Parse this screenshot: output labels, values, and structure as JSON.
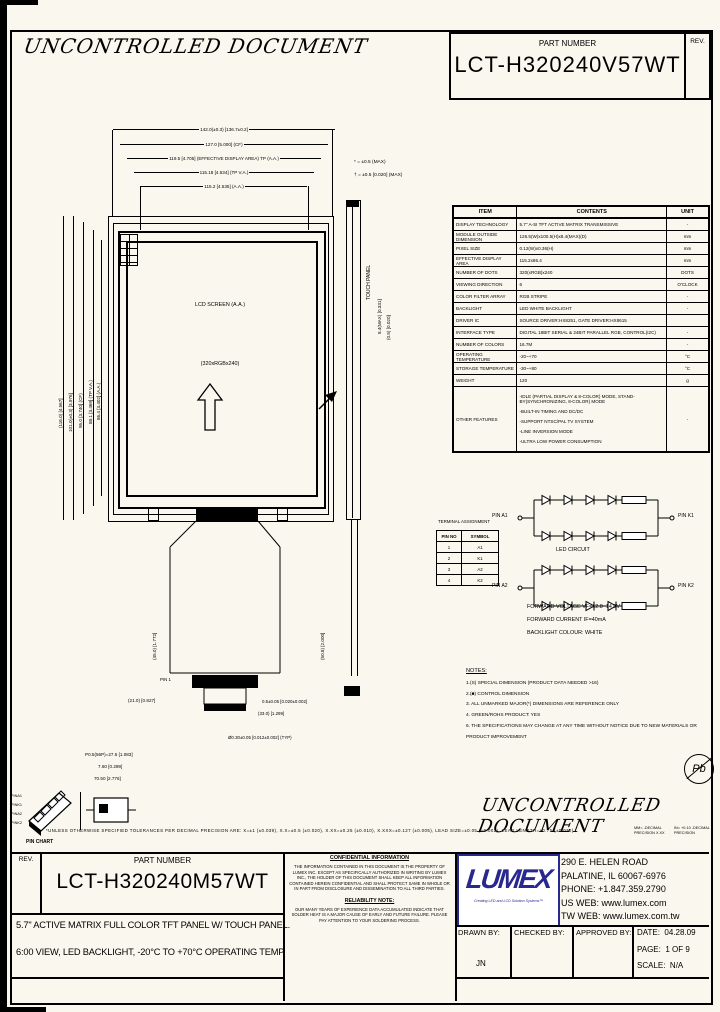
{
  "page": {
    "watermark_top": "UNCONTROLLED DOCUMENT",
    "watermark_bottom": "UNCONTROLLED DOCUMENT"
  },
  "header": {
    "part_number_label": "PART NUMBER",
    "part_number": "LCT-H320240V57WT",
    "rev_label": "REV."
  },
  "spec_table": {
    "headers": [
      "ITEM",
      "CONTENTS",
      "UNIT"
    ],
    "rows": [
      {
        "item": "DISPLAY TECHNOLOGY",
        "contents": "5.7\" A-SI TFT ACTIVE MATRIX TRANSMISSIVE",
        "unit": "-"
      },
      {
        "item": "MODULE OUTSIDE DIMENSION",
        "contents": "126.5(W)x100.5(H)x8.4(MAX)(D)",
        "unit": "mm"
      },
      {
        "item": "PIXEL SIZE",
        "contents": "0.12(W)x0.36(H)",
        "unit": "mm"
      },
      {
        "item": "EFFECTIVE DISPLAY AREA",
        "contents": "115.2x86.4",
        "unit": "mm"
      },
      {
        "item": "NUMBER OF DOTS",
        "contents": "320(xRGB)x240",
        "unit": "DOTS"
      },
      {
        "item": "VIEWING DIRECTION",
        "contents": "6",
        "unit": "O'CLOCK"
      },
      {
        "item": "COLOR FILTER ARRAY",
        "contents": "RGB STRIPE",
        "unit": "-"
      },
      {
        "item": "BACKLIGHT",
        "contents": "LED WHITE BACKLIGHT",
        "unit": "-"
      },
      {
        "item": "DRIVER IC",
        "contents": "SOURCE DRIVER:HX8251, GATE DRIVER:HX8615",
        "unit": ""
      },
      {
        "item": "INTERFACE TYPE",
        "contents": "DIGITAL 18BIT SERIAL & 24BIT PARALLEL RGB, CONTROL(I2C)",
        "unit": "-"
      },
      {
        "item": "NUMBER OF COLORS",
        "contents": "16.7M",
        "unit": "-"
      },
      {
        "item": "OPERATING TEMPERATURE",
        "contents": "-20~+70",
        "unit": "°C"
      },
      {
        "item": "STORAGE TEMPERATURE",
        "contents": "-30~+80",
        "unit": "°C"
      },
      {
        "item": "WEIGHT",
        "contents": "120",
        "unit": "g"
      }
    ],
    "other_features": {
      "item": "OTHER FEATURES",
      "lines": [
        "-IDLE (PARTIAL DISPLAY & 8-COLOR) MODE, STAND-BY(SYNCHRONIZING, 8-COLOR) MODE",
        "-BUILT-IN TIMING AND DC/DC",
        "-SUPPORT NTSC/PAL TV SYSTEM",
        "-LINE INVERSION MODE",
        "-ULTRA LOW POWER CONSUMPTION"
      ],
      "unit": "-"
    }
  },
  "drawing": {
    "top_dims": [
      "142.0(±0.3) [136.7±0.2]",
      "127.0 [5.000] (CF)",
      "119.5 [4.705] (EFFECTIVE DISPLAY AREA) TP (A.A.)",
      "115.18 [4.534] (TP V.A.)",
      "115.2 [4.535] (A.A.)"
    ],
    "left_dims": [
      "(116.0) [4.567]",
      "101.0(±0.3) [3.976]",
      "95.0 [3.740] (CF)",
      "88.1 [3.469] (TP V.A.)",
      "86.4 [3.402] (A.A.)"
    ],
    "legend": [
      "* = ±0.5 (MAX)",
      "† = ±0.5 [0.020] (MAX)"
    ],
    "screen_label": "LCD SCREEN (A.A.)",
    "dots_label": "(320xRGBx240)",
    "touch_panel_label": "TOUCH PANEL",
    "side_dims": [
      "8.4(MAX) [0.331]",
      "(0.5) [0.020]"
    ],
    "fpc_side_dim": "(50.8) [2.000]",
    "fpc_left_dim": "(45.0) [1.772]",
    "pin1_label": "PIN 1",
    "bottom_dims": [
      "(21.0) [0.827]",
      "0.5±0.05 [0.020±0.002]",
      "(33.0) [1.299]",
      "Ø0.30±0.05 [0.012±0.002] (TYP)",
      "P0.5(56P)=27.5 [1.083]",
      "7.60 [0.299]",
      "70.50 [2.776]"
    ]
  },
  "terminal_table": {
    "caption": "TERMINAL ASSIGNMENT",
    "headers": [
      "PIN NO",
      "SYMBOL"
    ],
    "rows": [
      [
        "1",
        "A1"
      ],
      [
        "2",
        "K1"
      ],
      [
        "3",
        "A2"
      ],
      [
        "4",
        "K2"
      ]
    ]
  },
  "led_circuit": {
    "caption": "LED CIRCUIT",
    "pin_a1": "PIN A1",
    "pin_k1": "PIN K1",
    "pin_a2": "PIN A2",
    "pin_k2": "PIN K2",
    "notes": [
      "FORWARD VOLTAGE VF=12.8~14.0V",
      "FORWARD CURRENT IF=40mA",
      "BACKLIGHT COLOUR: WHITE"
    ]
  },
  "notes": {
    "title": "NOTES:",
    "items": [
      "1.(S) SPECIAL DIMENSION (PRODUCT DATA NEEDED >16)",
      "2.(■) CONTROL DIMENSION",
      "3. ALL UNMARKED MAJOR(*) DIMENSIONS ARE REFERENCE ONLY",
      "4. GREEN/ROHS PRODUCT: YES",
      "6. THE SPECIFICATIONS MAY CHANGE AT ANY TIME WITHOUT NOTICE DUE TO NEW MATERIALS OR PRODUCT IMPROVEMENT"
    ]
  },
  "pin_chart": {
    "caption": "PIN CHART",
    "pins": [
      "PINA1",
      "PINK1",
      "PINA2",
      "PINK2"
    ]
  },
  "tolerance": {
    "main": "*UNLESS OTHERWISE SPECIFIED TOLERANCES PER DECIMAL PRECISION ARE: X=±1 (±0.039), X.X=±0.5 (±0.020), X.XX=±0.25 (±0.010), X.XXX=±0.127 (±0.005), LEAD SIZE=±0.05 (±0.002), LEAD LENGTH=±0.75 (±0.030)",
    "mm": "MM= -DECIMAL PRECISION X.XX",
    "inch": "IN= +0.10 -DECIMAL PRECISION"
  },
  "pb_mark": "Pb",
  "title_block": {
    "rev_label": "REV.",
    "part_number_label": "PART NUMBER",
    "part_number": "LCT-H320240M57WT",
    "description_line1": "5.7\" ACTIVE MATRIX FULL COLOR TFT PANEL W/ TOUCH PANEL.",
    "description_line2": "6:00 VIEW, LED BACKLIGHT, -20°C TO +70°C OPERATING TEMP.",
    "confidential_title": "CONFIDENTIAL INFORMATION",
    "confidential_body": "THE INFORMATION CONTAINED IN THIS DOCUMENT IS THE PROPERTY OF LUMEX INC. EXCEPT AS SPECIFICALLY AUTHORIZED IN WRITING BY LUMEX INC., THE HOLDER OF THIS DOCUMENT SHALL KEEP ALL INFORMATION CONTAINED HEREIN CONFIDENTIAL AND SHALL PROTECT SAME IN WHOLE OR IN PART FROM DISCLOSURE AND DISSEMINATION TO ALL THIRD PARTIES.",
    "reliability_title": "RELIABILITY NOTE:",
    "reliability_body": "OUR MANY YEARS OF EXPERIENCE DATA ACCUMULATED INDICATE THAT SOLDER HEAT IS A MAJOR CAUSE OF EARLY AND FUTURE FAILURE. PLEASE PAY ATTENTION TO YOUR SOLDERING PROCESS.",
    "logo_text": "LUMEX",
    "logo_tagline": "Creating LED and LCD Solution Systems™",
    "address_line1": "290 E. HELEN ROAD",
    "address_line2": "PALATINE, IL  60067-6976",
    "address_line3": "PHONE: +1.847.359.2790",
    "address_line4": "US WEB: www.lumex.com",
    "address_line5": "TW WEB: www.lumex.com.tw",
    "drawn_by_label": "DRAWN BY:",
    "drawn_by": "JN",
    "checked_by_label": "CHECKED BY:",
    "approved_by_label": "APPROVED BY:",
    "date_label": "DATE:",
    "date": "04.28.09",
    "page_label": "PAGE:",
    "page": "1 OF 9",
    "scale_label": "SCALE:",
    "scale": "N/A"
  },
  "colors": {
    "logo_navy": "#28288e",
    "paper": "#faf8ee",
    "line": "#000000"
  }
}
